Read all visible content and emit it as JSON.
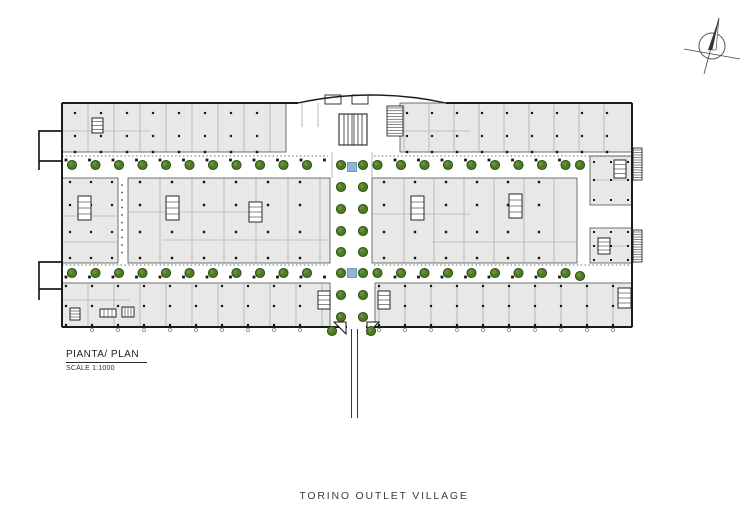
{
  "title": {
    "text": "TORINO OUTLET VILLAGE"
  },
  "plan_label": {
    "title": "PIANTA/ PLAN",
    "scale": "SCALE 1:1000"
  },
  "colors": {
    "background": "#ffffff",
    "block_fill": "#e8e8e6",
    "block_stroke": "#4f4f4f",
    "wall": "#1b1b1b",
    "partition": "#9b9b9b",
    "dotted": "#3f3f3f",
    "column": "#161616",
    "tree_fill": "#4d7b27",
    "tree_edge": "#2c4a14",
    "tree_light": "#6a9c3e",
    "water_fill": "#8cb7d6",
    "water_edge": "#5d87a6",
    "text": "#3c3c3c"
  },
  "plan": {
    "blocks": [
      [
        62,
        103,
        224,
        49
      ],
      [
        400,
        103,
        232,
        49
      ],
      [
        590,
        156,
        42,
        49
      ],
      [
        62,
        178,
        56,
        85
      ],
      [
        128,
        178,
        202,
        85
      ],
      [
        372,
        178,
        205,
        85
      ],
      [
        590,
        228,
        42,
        35
      ],
      [
        62,
        283,
        268,
        44
      ],
      [
        375,
        283,
        257,
        44
      ]
    ],
    "walls": [
      [
        [
          62,
          103
        ],
        [
          298,
          103
        ]
      ],
      [
        [
          446,
          103
        ],
        [
          632,
          103
        ]
      ],
      [
        [
          632,
          103
        ],
        [
          632,
          327
        ]
      ],
      [
        [
          632,
          327
        ],
        [
          366,
          327
        ]
      ],
      [
        [
          347,
          327
        ],
        [
          62,
          327
        ]
      ],
      [
        [
          62,
          327
        ],
        [
          62,
          103
        ]
      ]
    ],
    "roof_arc": [
      298,
      103,
      372,
      87,
      446,
      103
    ],
    "protrusions": [
      [
        [
          62,
          131
        ],
        [
          39,
          131
        ],
        [
          39,
          170
        ]
      ],
      [
        [
          39,
          161
        ],
        [
          62,
          161
        ]
      ],
      [
        [
          62,
          262
        ],
        [
          39,
          262
        ],
        [
          39,
          300
        ]
      ],
      [
        [
          39,
          289
        ],
        [
          62,
          289
        ]
      ]
    ],
    "partitions": [
      [
        88,
        283,
        26,
        103,
        152
      ],
      [
        404,
        624,
        25,
        103,
        152
      ],
      [
        160,
        322,
        32,
        178,
        263
      ],
      [
        404,
        570,
        30,
        178,
        263
      ],
      [
        88,
        326,
        26,
        283,
        327
      ],
      [
        379,
        624,
        26,
        283,
        327
      ]
    ],
    "hlines": [
      [
        62,
        131,
        150
      ],
      [
        400,
        131,
        470
      ],
      [
        62,
        216,
        118
      ],
      [
        62,
        242,
        118
      ],
      [
        128,
        212,
        252
      ],
      [
        162,
        240,
        330
      ],
      [
        372,
        214,
        470
      ],
      [
        432,
        242,
        577
      ],
      [
        594,
        180,
        628
      ],
      [
        594,
        246,
        628
      ],
      [
        62,
        300,
        130
      ]
    ],
    "extra_vlines": [
      [
        332,
        152,
        178
      ],
      [
        372,
        152,
        178
      ],
      [
        302,
        103,
        127
      ],
      [
        318,
        103,
        127
      ]
    ],
    "dotted": [
      [
        62,
        156,
        328
      ],
      [
        374,
        156,
        632
      ],
      [
        62,
        265,
        328
      ],
      [
        374,
        265,
        632
      ]
    ],
    "column_grids": [
      [
        75,
        281,
        26,
        2.2,
        [
          113,
          136
        ],
        null
      ],
      [
        407,
        627,
        25,
        2.2,
        [
          113,
          136
        ],
        null
      ],
      [
        75,
        281,
        26,
        2.4,
        [
          152
        ],
        null
      ],
      [
        407,
        627,
        25,
        2.4,
        [
          152
        ],
        null
      ],
      [
        66,
        566,
        23.5,
        2.8,
        [
          160,
          277
        ],
        [
          330,
          372
        ]
      ],
      [
        140,
        322,
        32,
        2.4,
        [
          182,
          205,
          232,
          258
        ],
        null
      ],
      [
        384,
        568,
        31,
        2.4,
        [
          182,
          205,
          232,
          258
        ],
        null
      ],
      [
        70,
        112,
        21,
        2.2,
        [
          182,
          205,
          232,
          258
        ],
        null
      ],
      [
        66,
        324,
        26,
        2.2,
        [
          286,
          306,
          325
        ],
        null
      ],
      [
        379,
        627,
        26,
        2.2,
        [
          286,
          306,
          325
        ],
        null
      ],
      [
        594,
        628,
        17,
        2,
        [
          162,
          180,
          200,
          232,
          246,
          260
        ],
        null
      ]
    ],
    "vdots": [
      122,
      185,
      257,
      7.5,
      1.5
    ],
    "door_marks": [
      [
        92,
        322,
        26,
        330
      ],
      [
        379,
        625,
        26,
        330
      ]
    ],
    "cores": [
      [
        78,
        196,
        13,
        24
      ],
      [
        166,
        196,
        13,
        24
      ],
      [
        249,
        202,
        13,
        20
      ],
      [
        411,
        196,
        13,
        24
      ],
      [
        509,
        194,
        13,
        24
      ],
      [
        318,
        291,
        12,
        18
      ],
      [
        378,
        291,
        12,
        18
      ],
      [
        92,
        118,
        11,
        15
      ],
      [
        614,
        160,
        12,
        18
      ],
      [
        598,
        238,
        12,
        16
      ],
      [
        618,
        288,
        13,
        20
      ],
      [
        70,
        308,
        10,
        12
      ],
      [
        100,
        309,
        16,
        8
      ],
      [
        122,
        307,
        12,
        10
      ]
    ],
    "escalator": [
      339,
      114,
      28,
      31
    ],
    "hatch_block": [
      387,
      106,
      16,
      30
    ],
    "side_stairs": [
      [
        633,
        148,
        9,
        32
      ],
      [
        633,
        230,
        9,
        32
      ]
    ],
    "skylights": [
      [
        325,
        95,
        16,
        9
      ],
      [
        352,
        95,
        16,
        9
      ]
    ],
    "tree_rows": {
      "step": 23.5,
      "r": 4.6,
      "x0": 72,
      "x1": 566,
      "rows": [
        165,
        273
      ],
      "skip": [
        328,
        374
      ]
    },
    "corridor_trees": {
      "cols": [
        341,
        363
      ],
      "rows": [
        165,
        187,
        209,
        231,
        252,
        273,
        295,
        317
      ],
      "r": 4.6
    },
    "extra_trees": [
      [
        580,
        165
      ],
      [
        580,
        276
      ],
      [
        332,
        331
      ],
      [
        371,
        331
      ]
    ],
    "water": {
      "points": [
        [
          352,
          167
        ],
        [
          352,
          273
        ]
      ],
      "size": 9
    },
    "entrance": {
      "path_lines": [
        [
          351.5,
          329,
          418
        ],
        [
          357.5,
          329,
          418
        ]
      ],
      "triangles": [
        [
          334,
          322,
          346,
          322,
          346,
          334
        ],
        [
          367,
          322,
          379,
          322,
          367,
          334
        ]
      ]
    }
  },
  "compass": {
    "cx": 712,
    "cy": 46,
    "r": 13,
    "line_a": [
      719,
      18,
      704,
      74
    ],
    "line_b": [
      684,
      49,
      740,
      59
    ],
    "needle_dark": [
      719,
      18,
      708,
      50,
      712,
      50
    ],
    "needle_light": [
      719,
      18,
      716,
      50,
      712,
      50
    ]
  }
}
